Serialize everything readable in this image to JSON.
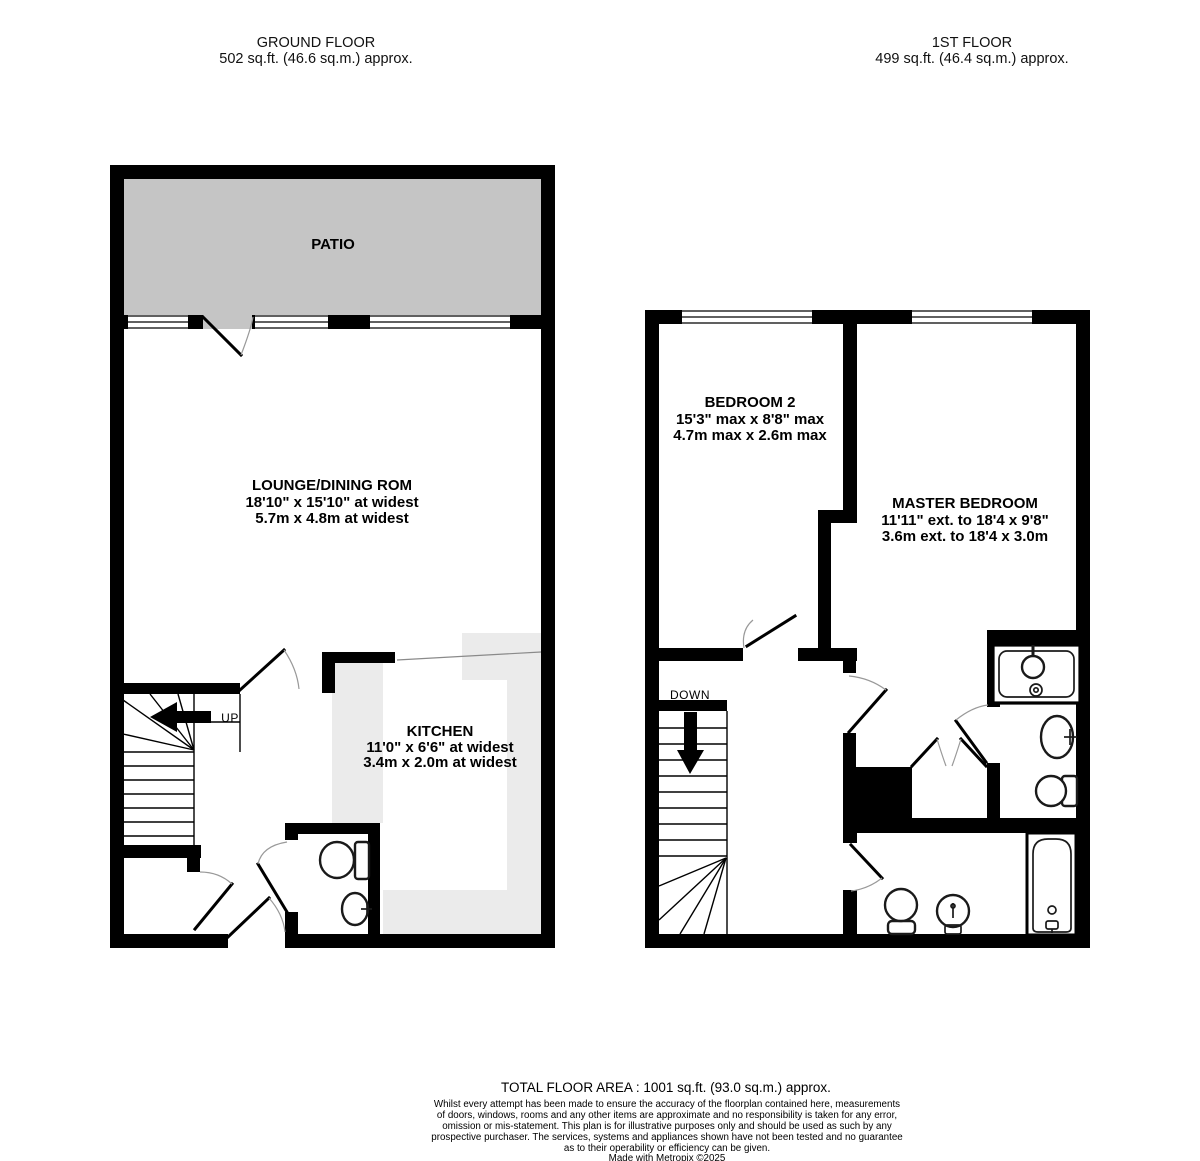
{
  "ground_floor": {
    "title": "GROUND FLOOR",
    "area_line": "502 sq.ft. (46.6 sq.m.) approx.",
    "patio_label": "PATIO",
    "lounge": {
      "name": "LOUNGE/DINING ROM",
      "dim_imperial": "18'10\"  x 15'10\" at widest",
      "dim_metric": "5.7m  x 4.8m at widest"
    },
    "kitchen": {
      "name": "KITCHEN",
      "dim_imperial": "11'0\"  x 6'6\" at widest",
      "dim_metric": "3.4m  x 2.0m at widest"
    },
    "stairs_label": "UP"
  },
  "first_floor": {
    "title": "1ST FLOOR",
    "area_line": "499 sq.ft. (46.4 sq.m.) approx.",
    "bedroom2": {
      "name": "BEDROOM 2",
      "dim_imperial": "15'3\" max x 8'8\" max",
      "dim_metric": "4.7m max x 2.6m max"
    },
    "master": {
      "name": "MASTER BEDROOM",
      "dim_imperial": "11'11\" ext. to 18'4 x 9'8\"",
      "dim_metric": "3.6m ext. to 18'4 x 3.0m"
    },
    "stairs_label": "DOWN"
  },
  "footer": {
    "total_area": "TOTAL FLOOR AREA : 1001 sq.ft. (93.0 sq.m.) approx.",
    "disclaimer_lines": [
      "Whilst every attempt has been made to ensure the accuracy of the floorplan contained here, measurements",
      "of doors, windows, rooms and any other items are approximate and no responsibility is taken for any error,",
      "omission or mis-statement. This plan is for illustrative purposes only and should be used as such by any",
      "prospective purchaser. The services, systems and appliances shown have not been tested and no guarantee",
      "as to their operability or efficiency can be given."
    ],
    "credit": "Made with Metropix ©2025"
  },
  "colors": {
    "wall": "#000000",
    "patio_fill": "#c5c5c5",
    "kitchen_fill": "#ebebeb",
    "door_arc": "#999999"
  }
}
